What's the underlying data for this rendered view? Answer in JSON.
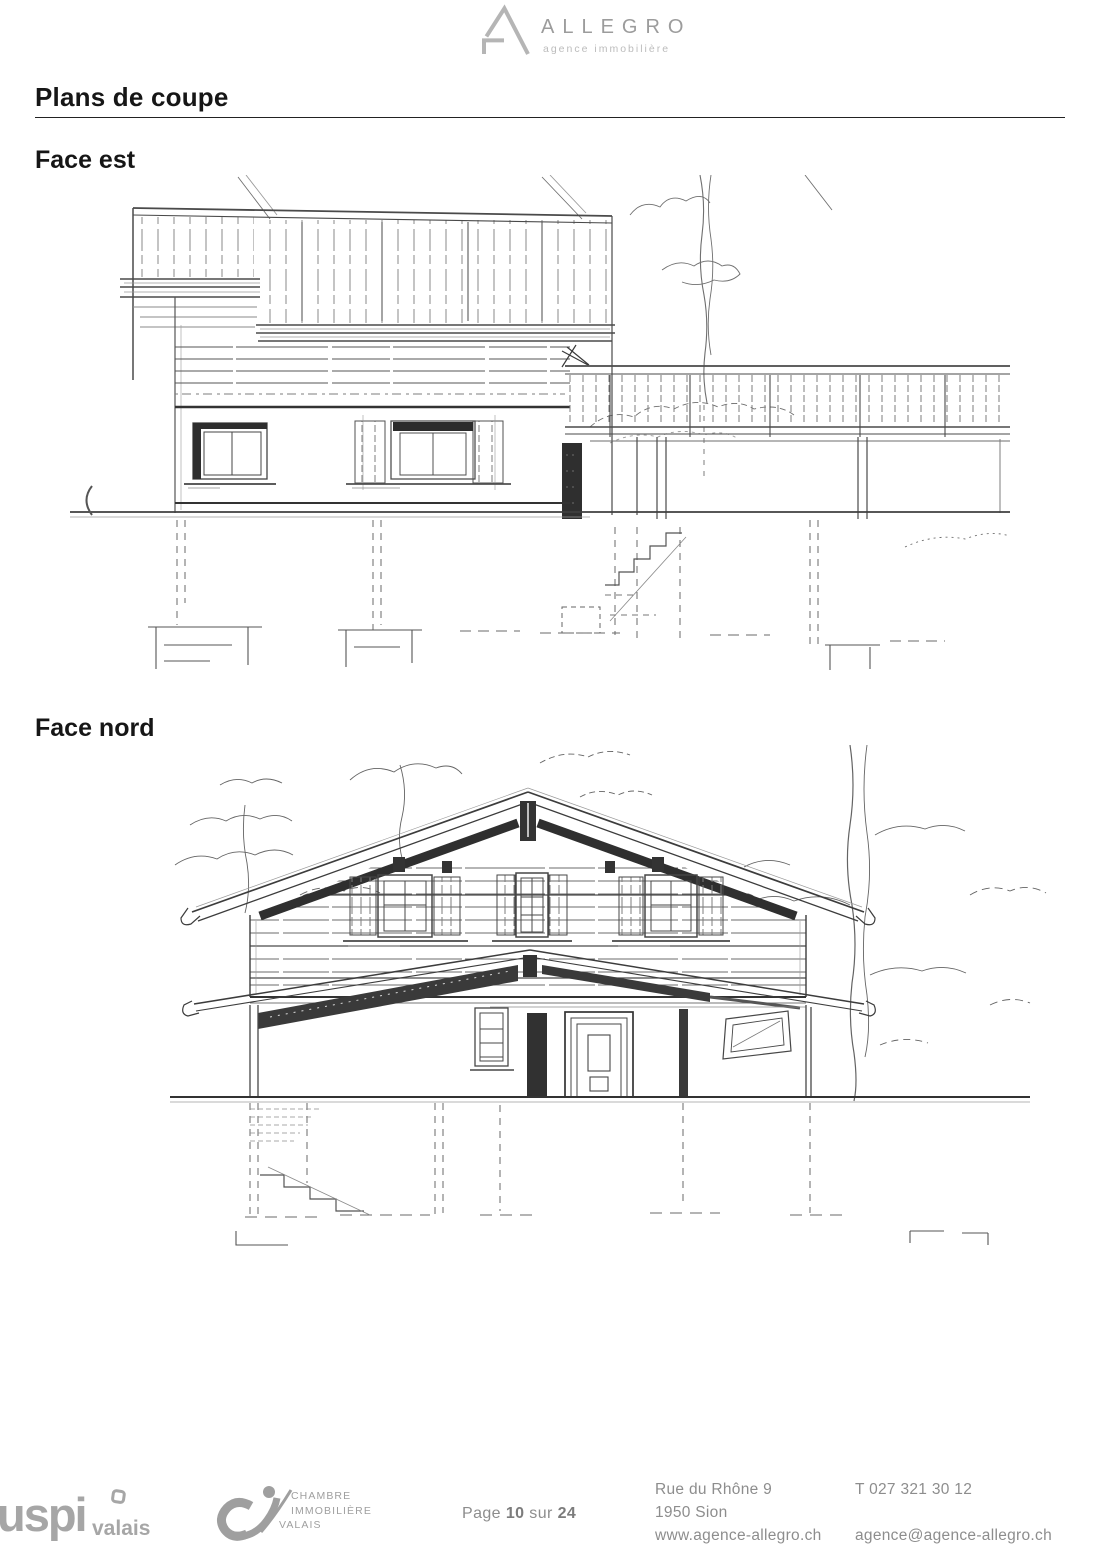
{
  "header": {
    "brand": "ALLEGRO",
    "tagline": "agence immobilière"
  },
  "page_title": "Plans de coupe",
  "sections": {
    "east": {
      "label": "Face est"
    },
    "north": {
      "label": "Face nord"
    }
  },
  "figures": {
    "east": "east-elevation-sketch",
    "north": "north-elevation-sketch"
  },
  "footer": {
    "uspi": {
      "name": "uspi",
      "region": "valais"
    },
    "ci": {
      "lines": [
        "CHAMBRE",
        "IMMOBILIÈRE",
        "VALAIS"
      ]
    },
    "page": {
      "prefix": "Page",
      "current": "10",
      "separator": "sur",
      "total": "24"
    },
    "address": [
      "Rue du Rhône 9",
      "1950 Sion",
      "www.agence-allegro.ch"
    ],
    "contact": {
      "phone": "T 027 321 30 12",
      "email": "agence@agence-allegro.ch"
    }
  },
  "colors": {
    "heading": "#161616",
    "footer_text": "#8d8d8d",
    "logo_gray": "#b5b5b5",
    "brand_gray": "#9c9c9c",
    "sketch_ink": "#3c3c3c"
  }
}
